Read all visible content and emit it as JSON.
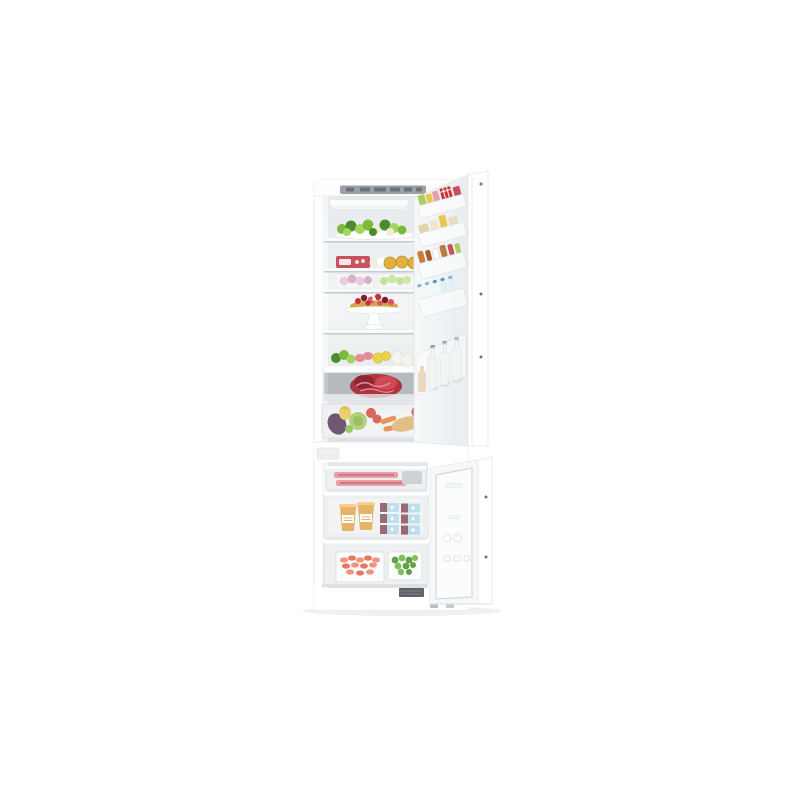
{
  "page": {
    "background": "#ffffff"
  },
  "image": {
    "alt": "Built-in fridge freezer combination with both doors open, fridge compartment on top filled with fresh food and bottles, freezer drawers below with frozen food",
    "parts": [
      "cabinet",
      "control-panel",
      "led-light",
      "fridge-interior",
      "glass-shelves",
      "salad-platter",
      "deli-shelf",
      "produce-bins",
      "berry-tart-on-cake-stand",
      "veggie-and-egg-shelf",
      "meat-drawer",
      "crisper-drawer",
      "fridge-door",
      "door-bins",
      "door-bottle-rack",
      "freezer-interior",
      "freezer-top-drawer",
      "freezer-middle-drawer",
      "freezer-bottom-drawer",
      "freezer-door",
      "base-grille",
      "feet"
    ]
  },
  "colors": {
    "bg": "#ffffff",
    "cabinetWhite": "#ffffff",
    "cabinetEdge": "#e3e6e9",
    "panelGray": "#99a0a6",
    "panelDark": "#6b7177",
    "interiorTop": "#e6eaec",
    "interiorMid": "#f3f5f6",
    "interiorBottom": "#dde1e4",
    "shelfWhite": "#fbfcfc",
    "shelfShadow": "#c3c9cd",
    "drawerGray": "#c2c7cb",
    "drawerInner": "#b4babe",
    "frameLight": "#eef0f2",
    "frameStroke": "#d8dcdf",
    "saladGreen": "#7cb93f",
    "saladDark": "#4e8a2e",
    "saladLight": "#a5d45c",
    "cauliflower": "#f0edda",
    "salamiRed": "#c9505e",
    "tartGold": "#e2b13c",
    "tartEdge": "#c08c2a",
    "berryRed": "#c22f45",
    "berryLight": "#e05263",
    "berryDark": "#7e1f2e",
    "crustGold": "#d9a441",
    "pinkFruit": "#d9a0c4",
    "purpleFruit": "#b86fa5",
    "grapeGreen": "#9cc84e",
    "lemonYellow": "#ecd24f",
    "lemonRind": "#d8bf3a",
    "eggWhite": "#f6f3ee",
    "eggShade": "#e4dfd7",
    "meatRed": "#b03340",
    "meatDark": "#8c2733",
    "meatMarble": "#e8909a",
    "hamPink": "#e88a96",
    "eggplantPurple": "#472a4d",
    "cabbageGreen": "#9cc455",
    "cabbageDark": "#7fae3e",
    "tomatoRed": "#d33b2d",
    "carrotOrange": "#e0762a",
    "breadBeige": "#d9ad67",
    "appleRed": "#c63333",
    "pearYellow": "#e3c04a",
    "baconPink": "#e8a0a8",
    "baconStripe": "#c96a74",
    "palePack": "#cdd2d5",
    "cupOrange": "#e09a36",
    "cupRim": "#f4c265",
    "boxMaroon": "#7a3644",
    "boxBlue": "#a9d6e8",
    "shrimpPink": "#f2917c",
    "shrimpDeep": "#e8765f",
    "frozenGreen": "#5fa243",
    "frozenGreenLight": "#7fbf57",
    "glassTint": "#e6eeec",
    "glassStroke": "#c9d4d2",
    "capGray": "#8f979c",
    "amberBottle": "#d9b98a",
    "condimentBrown": "#c77f3a",
    "condimentDark": "#a95c2e",
    "butterBeige": "#e3d3ae",
    "creamBox": "#efe6cf",
    "yellowCarton": "#e8c84e",
    "checkerRed": "#c8323c",
    "milkBlue": "#7fb6d9",
    "aquaCap": "#5d98ba",
    "greenPack": "#a9cf60",
    "hingeDark": "#6f757a",
    "grilleDark": "#5c6267",
    "grilleSlot": "#7a8085",
    "footGray": "#b9bfc4",
    "doorFace": "#f6f8f9",
    "doorFaceShade": "#e9edef",
    "gasketLine": "#d4d8db",
    "embossLine": "#e7eaec",
    "groundShadow": "#eef0f1"
  }
}
